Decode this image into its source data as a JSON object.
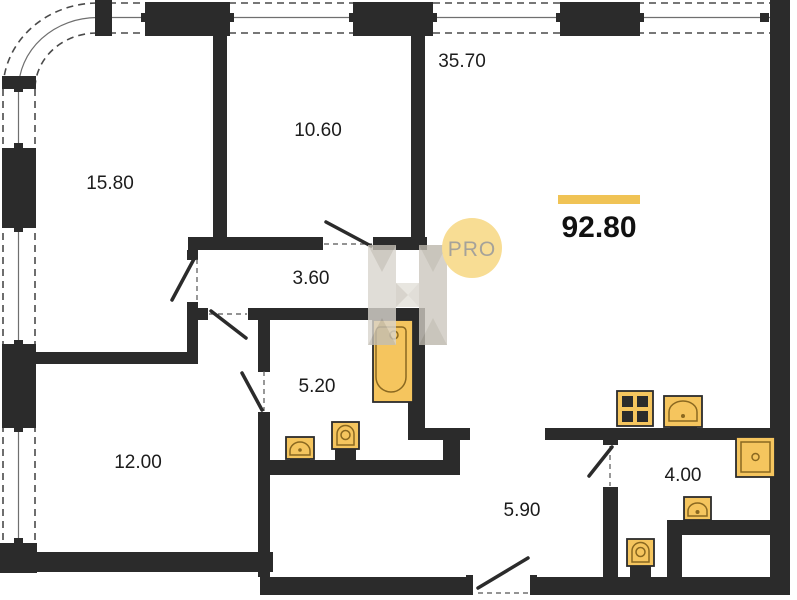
{
  "plan_type": "apartment-floor-plan",
  "watermark": {
    "badge_text": "PRO",
    "logo": "H-monogram"
  },
  "total": {
    "area": "92.80"
  },
  "rooms": [
    {
      "id": "living-kitchen",
      "area": "35.70"
    },
    {
      "id": "bedroom-top-left",
      "area": "15.80"
    },
    {
      "id": "bedroom-top-middle",
      "area": "10.60"
    },
    {
      "id": "corridor",
      "area": "3.60"
    },
    {
      "id": "bathroom",
      "area": "5.20"
    },
    {
      "id": "bedroom-bottom-left",
      "area": "12.00"
    },
    {
      "id": "hallway",
      "area": "5.90"
    },
    {
      "id": "wc",
      "area": "4.00"
    }
  ],
  "fixtures": [
    "bathtub-icon",
    "washbasin-icon",
    "toilet-icon",
    "stove-4-burner-icon",
    "kitchen-sink-icon",
    "square-basin-icon",
    "washbasin-small-icon",
    "toilet-small-icon"
  ],
  "colors": {
    "wall": "#2b2b2b",
    "fixture_fill": "#f5c55e",
    "fixture_detail": "#8a6820",
    "accent_bar": "#f0c355",
    "badge_fill": "#f8dd94",
    "badge_text": "#a5a29a",
    "watermark_gray": "#d9d5ce"
  }
}
